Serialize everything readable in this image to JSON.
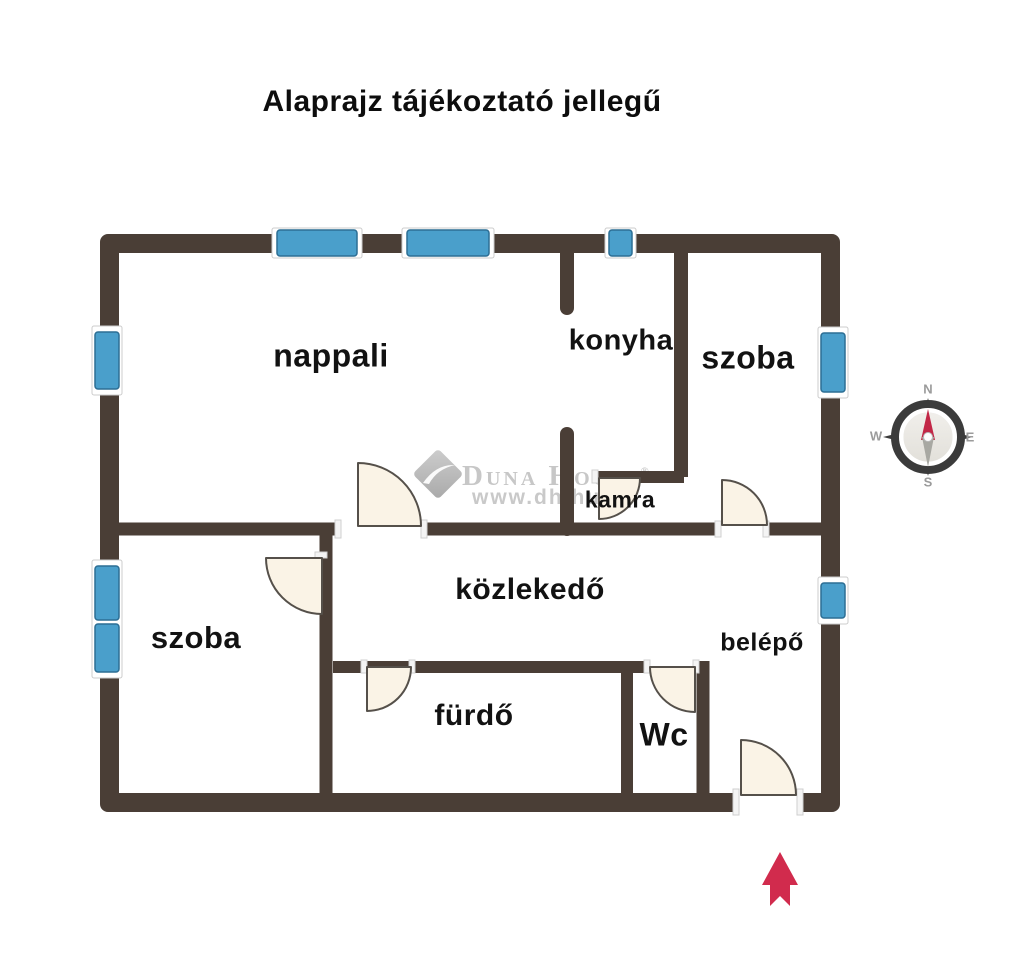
{
  "title": "Alaprajz tájékoztató jellegű",
  "rooms": {
    "nappali": "nappali",
    "konyha": "konyha",
    "szoba_top": "szoba",
    "kamra": "kamra",
    "kozlekedo": "közlekedő",
    "belepo": "belépő",
    "szoba_bottom": "szoba",
    "furdo": "fürdő",
    "wc": "Wc"
  },
  "compass": {
    "n": "N",
    "e": "E",
    "s": "S",
    "w": "W"
  },
  "watermark": {
    "brand": "Duna House",
    "registered": "®",
    "url": "www.dh.hu"
  },
  "colors": {
    "wall": "#4a3e36",
    "window_fill": "#4a9fcb",
    "window_border": "#2c6e94",
    "door_fill": "#faf3e6",
    "door_stroke": "#55504a",
    "entry_arrow": "#d12b4d",
    "watermark_gray": "#c7c7c7",
    "compass_dark": "#3b3b3b",
    "compass_needle_red": "#c22747"
  }
}
